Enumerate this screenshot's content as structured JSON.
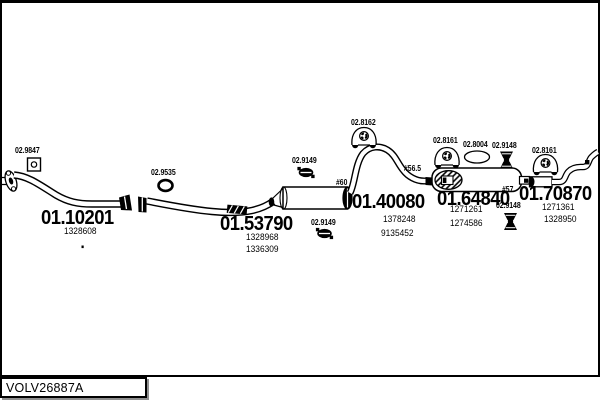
{
  "page": {
    "drawing_code": "VOLV26887A"
  },
  "assemblies": [
    {
      "number": "01.10201",
      "refs": [
        "1328608"
      ]
    },
    {
      "number": "01.53790",
      "refs": [
        "1328968",
        "1336309"
      ]
    },
    {
      "number": "01.40080",
      "refs": [
        "1378248",
        "9135452"
      ]
    },
    {
      "number": "01.64840",
      "refs": [
        "1271261",
        "1274586"
      ]
    },
    {
      "number": "01.70870",
      "refs": [
        "1271361",
        "1328950"
      ]
    }
  ],
  "fittings": [
    {
      "number": "02.9847",
      "type": "square-gasket"
    },
    {
      "number": "02.9535",
      "type": "o-ring"
    },
    {
      "number": "02.9149",
      "type": "clamp"
    },
    {
      "number": "02.9149",
      "type": "clamp"
    },
    {
      "number": "02.8162",
      "type": "rubber-hanger"
    },
    {
      "number": "02.8161",
      "type": "rubber-hanger"
    },
    {
      "number": "02.8004",
      "type": "oval-gasket"
    },
    {
      "number": "02.9148",
      "type": "clamp"
    },
    {
      "number": "02.9148",
      "type": "clamp"
    },
    {
      "number": "02.8161",
      "type": "rubber-hanger"
    }
  ],
  "diameters": [
    {
      "label": "#60"
    },
    {
      "label": "#56.5"
    },
    {
      "label": "#57"
    }
  ],
  "colors": {
    "ink": "#000000",
    "paper": "#ffffff"
  }
}
